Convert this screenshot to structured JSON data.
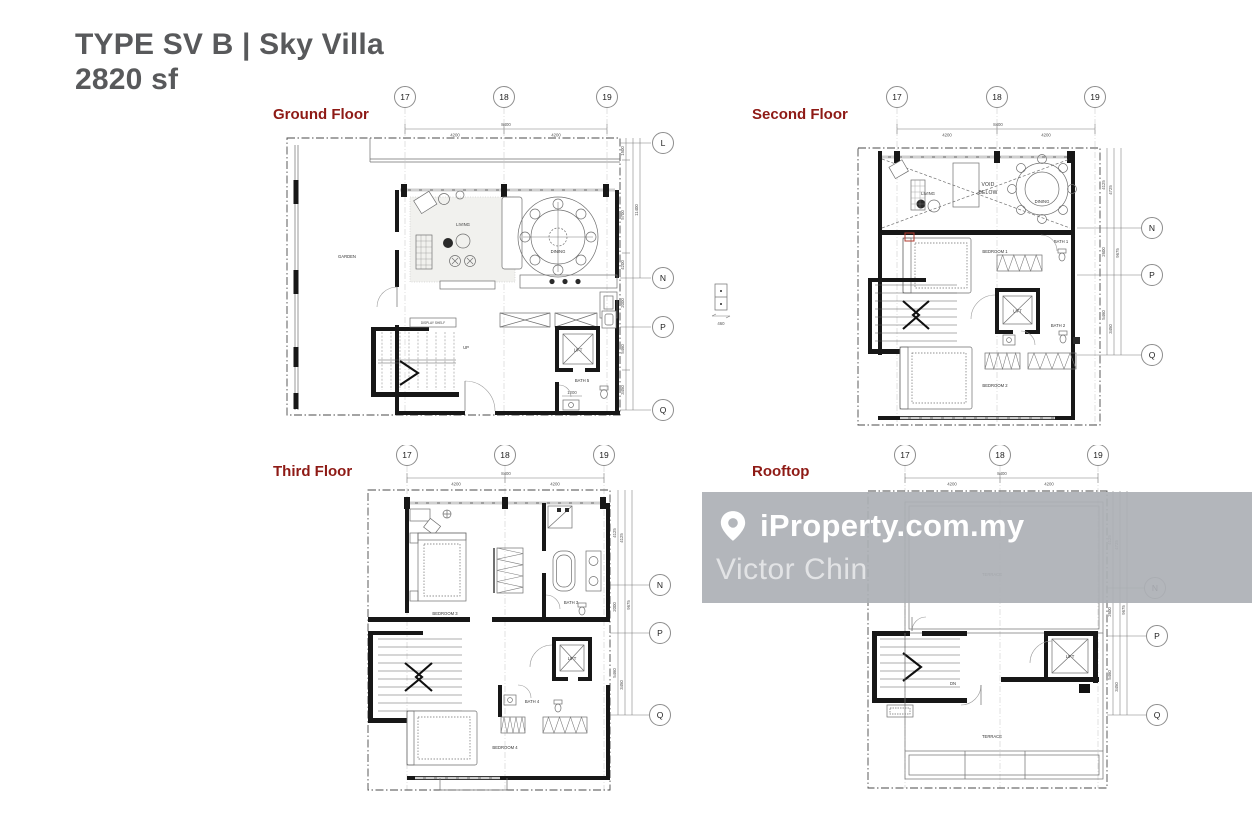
{
  "page": {
    "title_line1": "TYPE SV B | Sky Villa",
    "title_line2": "2820 sf"
  },
  "colors": {
    "title_text": "#58595b",
    "floor_label": "#8e1a15",
    "watermark_band": "#acb0b5",
    "wall": "#171717",
    "marker_red": "#b03a2e"
  },
  "watermark": {
    "brand": "iProperty.com.my",
    "agent": "Victor Chin"
  },
  "grid": {
    "top_labels": [
      "17",
      "18",
      "19"
    ],
    "top_total": "8400",
    "top_seg": "4200"
  },
  "mid_detail": {
    "dim": "460"
  },
  "floors": [
    {
      "name": "Ground Floor",
      "side_labels": [
        "L",
        "N",
        "P",
        "Q"
      ],
      "side_dims": [
        "1500",
        "5700",
        "4200",
        "11400",
        "2000",
        "5460",
        "3450"
      ],
      "rooms": {
        "garden": "GARDEN",
        "living": "LIVING",
        "dining": "DINING",
        "display_shelf": "DISPLAY SHELF",
        "lift": "LIFT",
        "bath5": "BATH 5",
        "stair_dir": "UP",
        "bath_dim": "1200"
      }
    },
    {
      "name": "Second Floor",
      "side_labels": [
        "N",
        "P",
        "Q"
      ],
      "side_dims": [
        "4125",
        "4725",
        "9675",
        "2600",
        "5460",
        "3450"
      ],
      "rooms": {
        "living": "LIVING",
        "void_l1": "VOID",
        "void_l2": "BELOW",
        "dining": "DINING",
        "bedroom1": "BEDROOM 1",
        "bath1": "BATH 1",
        "lift": "LIFT",
        "bath2": "BATH 2",
        "bedroom2": "BEDROOM 2"
      }
    },
    {
      "name": "Third Floor",
      "side_labels": [
        "N",
        "P",
        "Q"
      ],
      "side_dims": [
        "4125",
        "4125",
        "9675",
        "2000",
        "5460",
        "3450"
      ],
      "rooms": {
        "bedroom3": "BEDROOM 3",
        "bath3": "BATH 3",
        "lift": "LIFT",
        "bath4": "BATH 4",
        "bedroom4": "BEDROOM 4"
      }
    },
    {
      "name": "Rooftop",
      "side_labels": [
        "N",
        "P",
        "Q"
      ],
      "side_dims": [
        "4125",
        "4725",
        "9675",
        "2600",
        "5460",
        "3450"
      ],
      "rooms": {
        "terrace_upper": "TERRACE",
        "lift": "LIFT",
        "terrace_lower": "TERRACE",
        "stair_dir": "DN"
      }
    }
  ]
}
